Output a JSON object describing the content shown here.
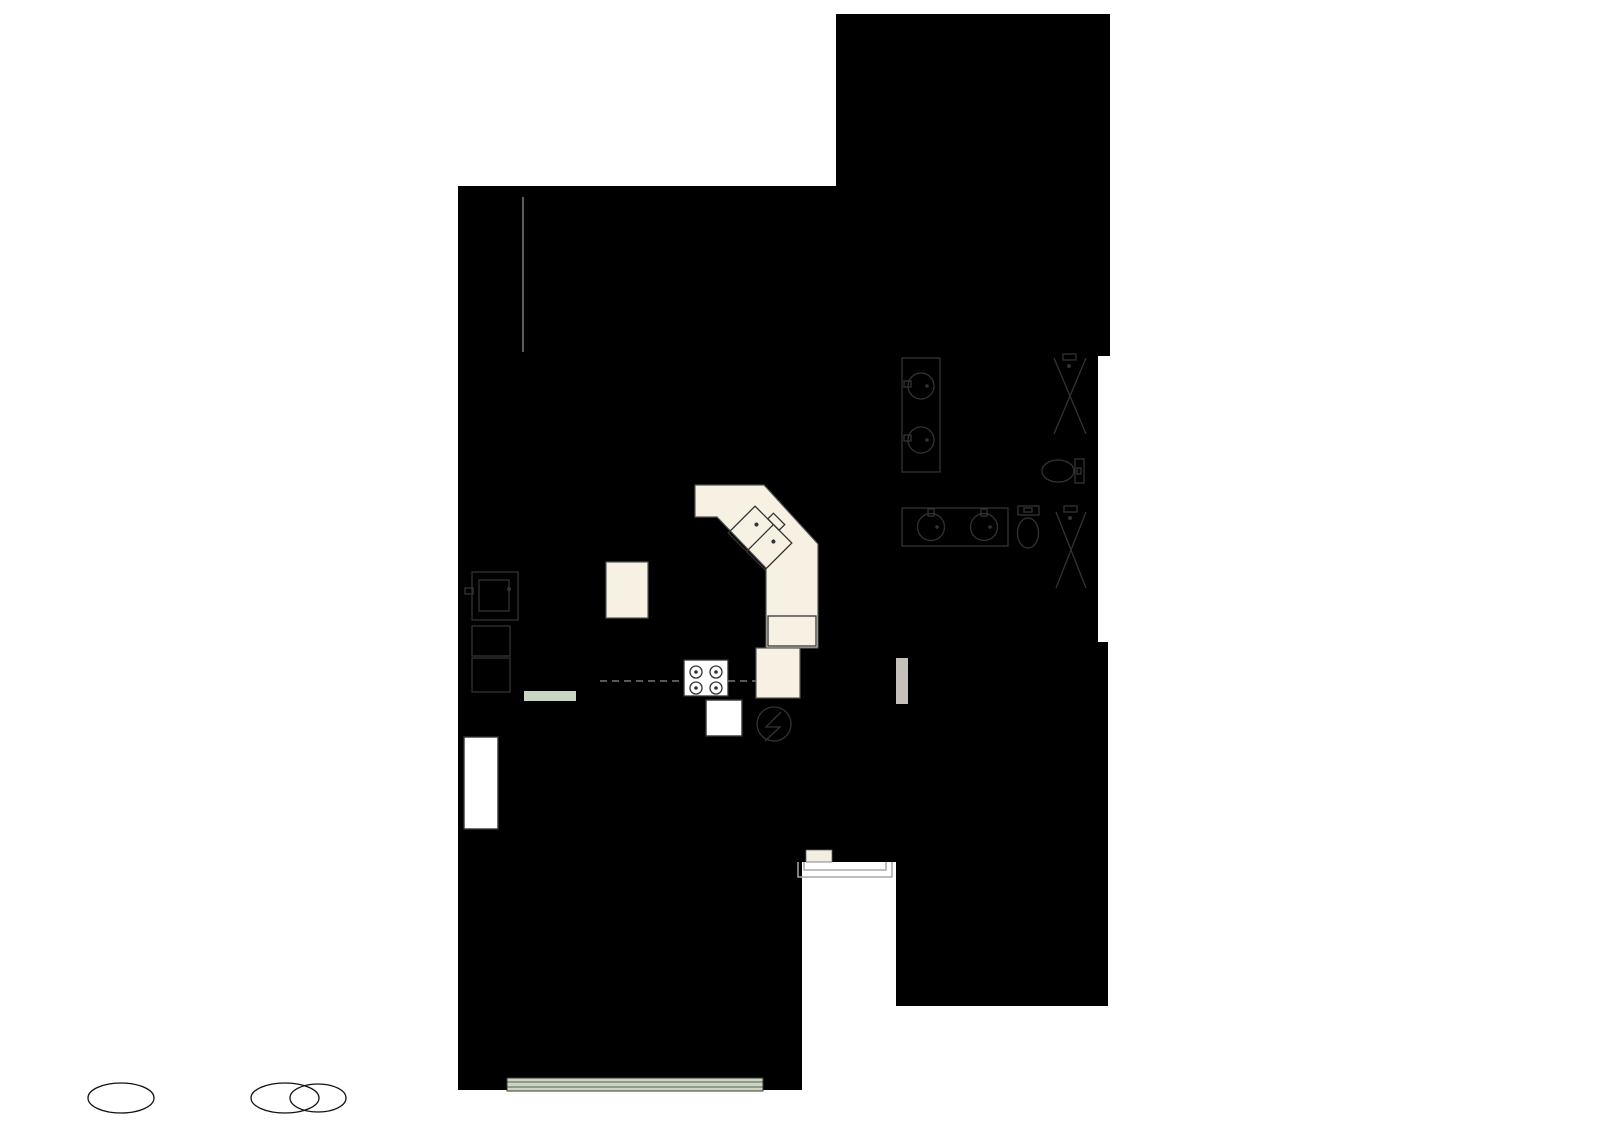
{
  "watermark": {
    "text": "Bolier photography"
  },
  "colors": {
    "floor_main": "#f2ead8",
    "floor_bedroom": "#b5a1a1",
    "floor_bath": "#a9adc4",
    "floor_garage": "#a9bda4",
    "wall": "#141414",
    "garage_wall": "#1e2b13",
    "window_glass": "#e9e9e9"
  },
  "rooms": [
    {
      "id": "living-room",
      "name": "LIVING ROOM",
      "dims": "24'8\" x 13'5\""
    },
    {
      "id": "dining-area",
      "name": "DINING AREA",
      "dims": "7'5\" x 11'2\""
    },
    {
      "id": "kitchen",
      "name": "KITCHEN",
      "dims": "17'3\" x 15'8\""
    },
    {
      "id": "laundry",
      "name": "LAUNDRY",
      "dims": "7'3\" x 8'5\""
    },
    {
      "id": "foyer",
      "name": "FOYER",
      "dims": "5'5\" x 11'5\""
    },
    {
      "id": "garage",
      "name": "GARAGE",
      "dims": "18'9\" x 22'8\""
    },
    {
      "id": "primary-bedroom",
      "name": "PRIMARY BEDROOM",
      "dims": "15'3\" x 19'2\""
    },
    {
      "id": "primary-wic",
      "name": "W.I.C.",
      "dims": "6'4\" x 5'1\""
    },
    {
      "id": "bath-primary",
      "name": "BATH",
      "dims": "11'8\" x 8'3\""
    },
    {
      "id": "bath-hall",
      "name": "BATH",
      "dims": "11'8\" x 8'0\""
    },
    {
      "id": "bedroom-wic",
      "name": "W.I.C.",
      "dims": "5'0\" x 6'7\""
    },
    {
      "id": "bedroom",
      "name": "BEDROOM",
      "dims": "11'8\" x 20'9\""
    }
  ]
}
